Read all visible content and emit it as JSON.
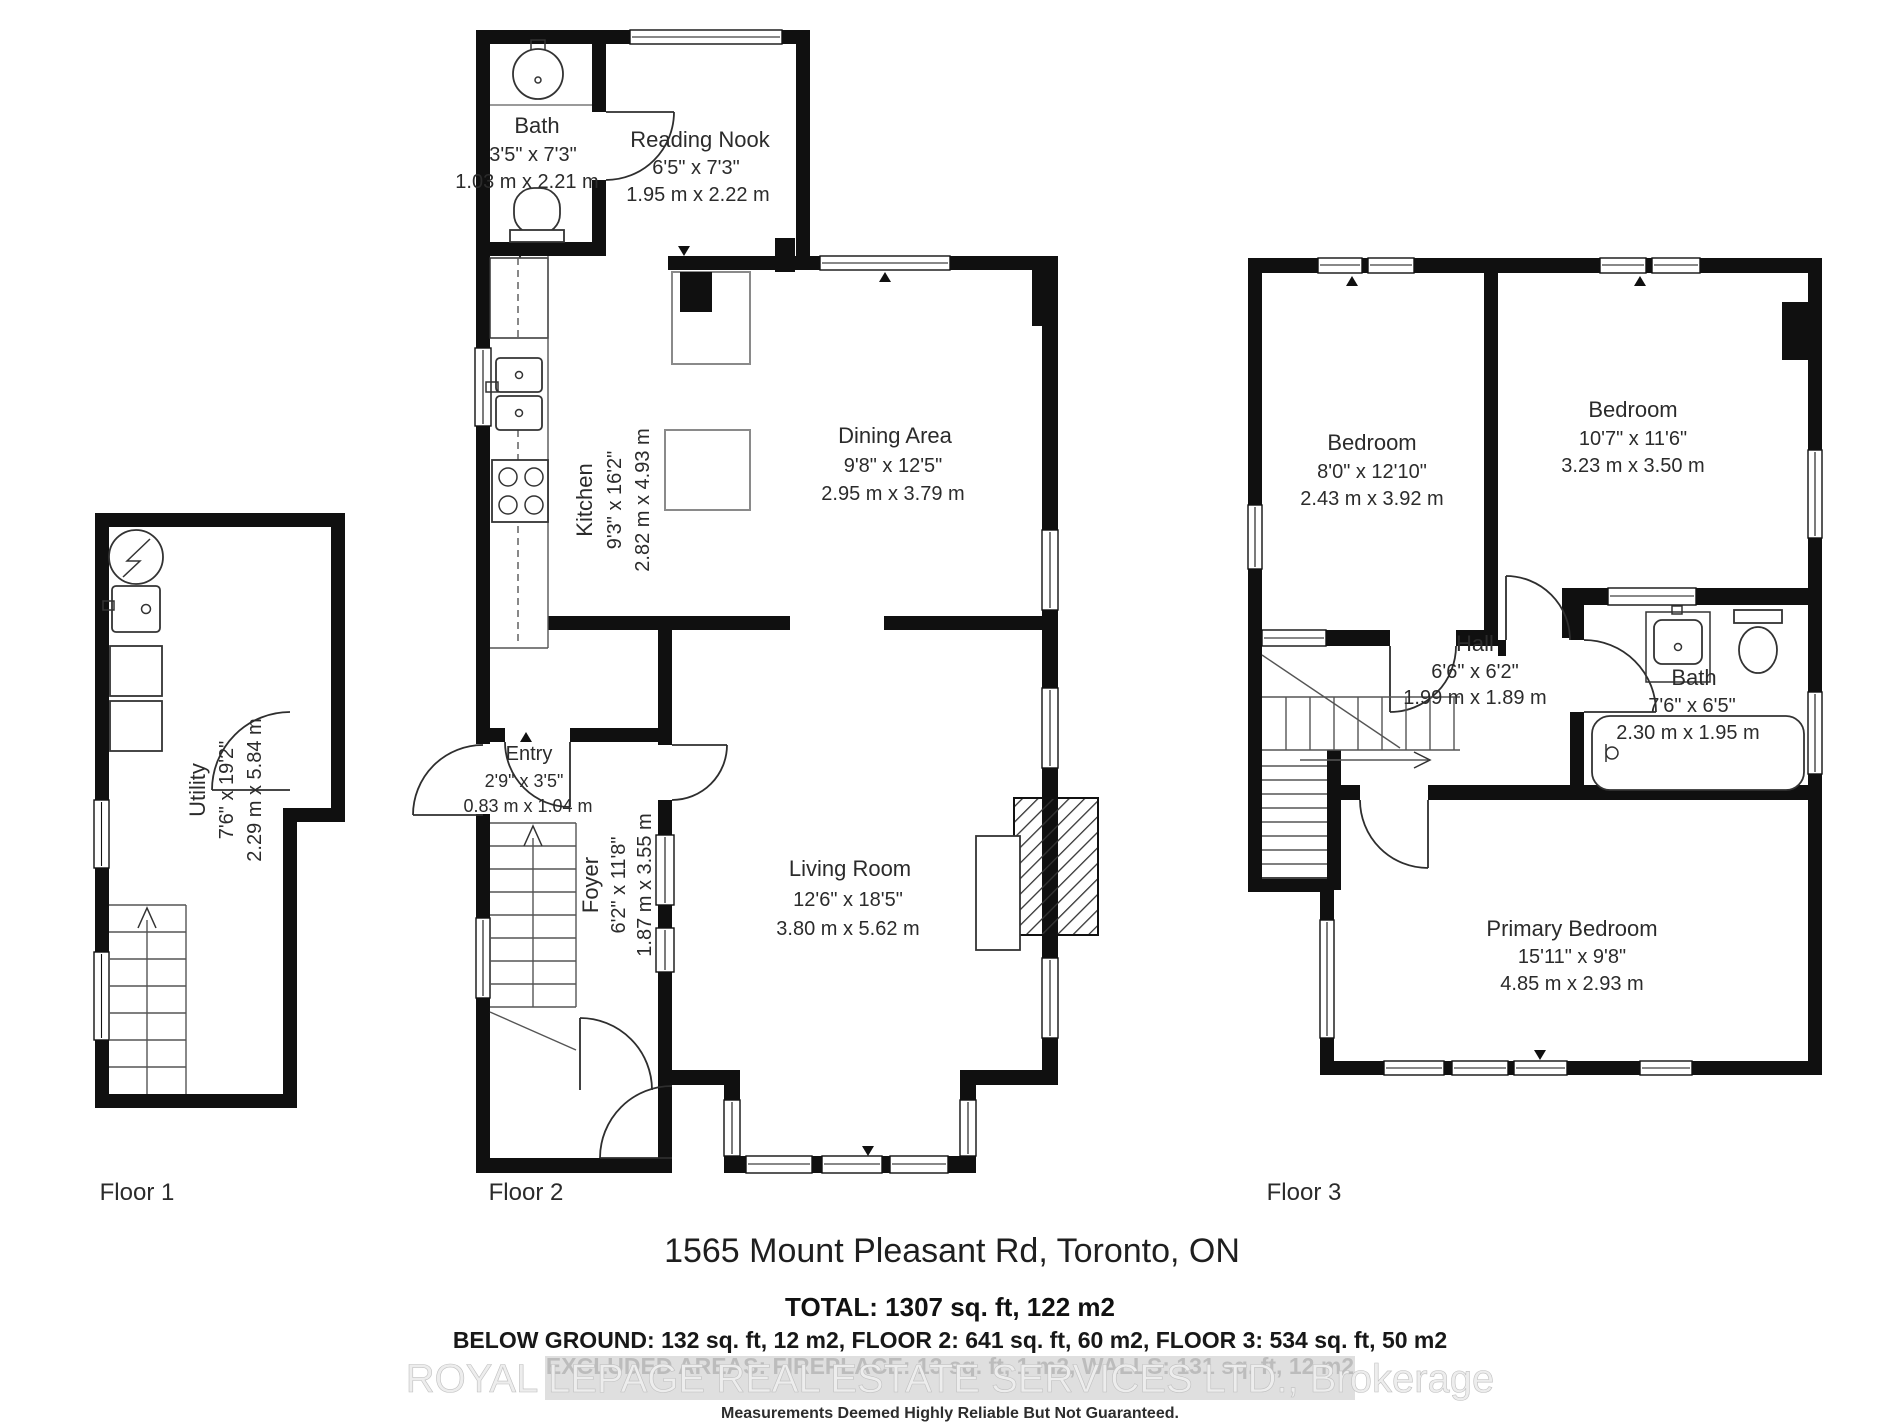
{
  "header": {
    "address": "1565 Mount Pleasant Rd, Toronto, ON"
  },
  "floors": [
    {
      "label": "Floor 1"
    },
    {
      "label": "Floor 2"
    },
    {
      "label": "Floor 3"
    }
  ],
  "rooms": {
    "utility": {
      "name": "Utility",
      "imperial": "7'6\" x 19'2\"",
      "metric": "2.29 m x 5.84 m"
    },
    "bath_f2": {
      "name": "Bath",
      "imperial": "3'5\" x 7'3\"",
      "metric": "1.03 m x 2.21 m"
    },
    "reading_nook": {
      "name": "Reading Nook",
      "imperial": "6'5\" x 7'3\"",
      "metric": "1.95 m x 2.22 m"
    },
    "kitchen": {
      "name": "Kitchen",
      "imperial": "9'3\" x 16'2\"",
      "metric": "2.82 m x 4.93 m"
    },
    "dining": {
      "name": "Dining Area",
      "imperial": "9'8\" x 12'5\"",
      "metric": "2.95 m x 3.79 m"
    },
    "entry": {
      "name": "Entry",
      "imperial": "2'9\" x 3'5\"",
      "metric": "0.83 m x 1.04 m"
    },
    "foyer": {
      "name": "Foyer",
      "imperial": "6'2\" x 11'8\"",
      "metric": "1.87 m x 3.55 m"
    },
    "living": {
      "name": "Living Room",
      "imperial": "12'6\" x 18'5\"",
      "metric": "3.80 m x 5.62 m"
    },
    "bedroom_left": {
      "name": "Bedroom",
      "imperial": "8'0\" x 12'10\"",
      "metric": "2.43 m x 3.92 m"
    },
    "bedroom_right": {
      "name": "Bedroom",
      "imperial": "10'7\" x 11'6\"",
      "metric": "3.23 m x 3.50 m"
    },
    "hall": {
      "name": "Hall",
      "imperial": "6'6\" x 6'2\"",
      "metric": "1.99 m x 1.89 m"
    },
    "bath_f3": {
      "name": "Bath",
      "imperial": "7'6\" x 6'5\"",
      "metric": "2.30 m x 1.95 m"
    },
    "primary": {
      "name": "Primary Bedroom",
      "imperial": "15'11\" x 9'8\"",
      "metric": "4.85 m x 2.93 m"
    }
  },
  "footer": {
    "total": "TOTAL: 1307 sq. ft, 122 m2",
    "breakdown": "BELOW GROUND: 132 sq. ft, 12 m2, FLOOR 2: 641 sq. ft, 60 m2, FLOOR 3: 534 sq. ft, 50 m2",
    "excluded": "EXCLUDED AREAS: FIREPLACE: 13 sq. ft, 1 m2, WALLS: 131 sq. ft, 12 m2",
    "watermark": "ROYAL LEPAGE REAL ESTATE SERVICES LTD., Brokerage",
    "disclaimer": "Measurements Deemed Highly Reliable But Not Guaranteed."
  }
}
